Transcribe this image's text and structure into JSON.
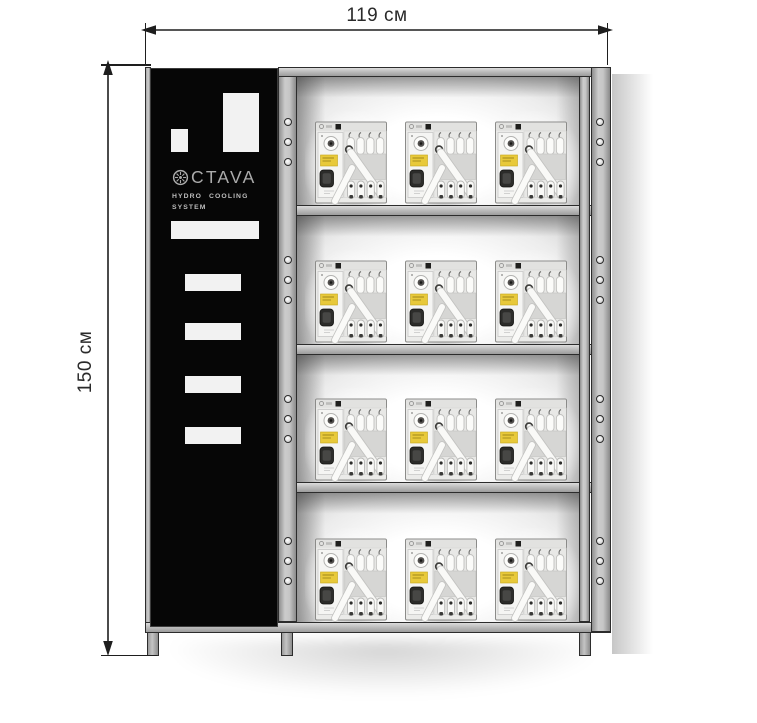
{
  "diagram": {
    "width_label": "119 см",
    "height_label": "150 см"
  },
  "brand_panel": {
    "logo_text": "CTAVA",
    "logo_icon_name": "impeller-gear-icon",
    "subtitle_line1": "HYDRO COOLING",
    "subtitle_line2": "SYSTEM"
  },
  "rack": {
    "shelf_count": 4,
    "units_per_shelf": 3,
    "total_units": 12,
    "mounting_holes_per_section": 3
  },
  "colors": {
    "frame_gray": "#b9b9b9",
    "outline_dark": "#2c2c2c",
    "panel_black": "#060606",
    "logo_gray": "#ababab",
    "sticker_yellow": "#e8c93a",
    "unit_body_gray": "#ebebe9",
    "dimension_text": "#2a2a2a"
  }
}
